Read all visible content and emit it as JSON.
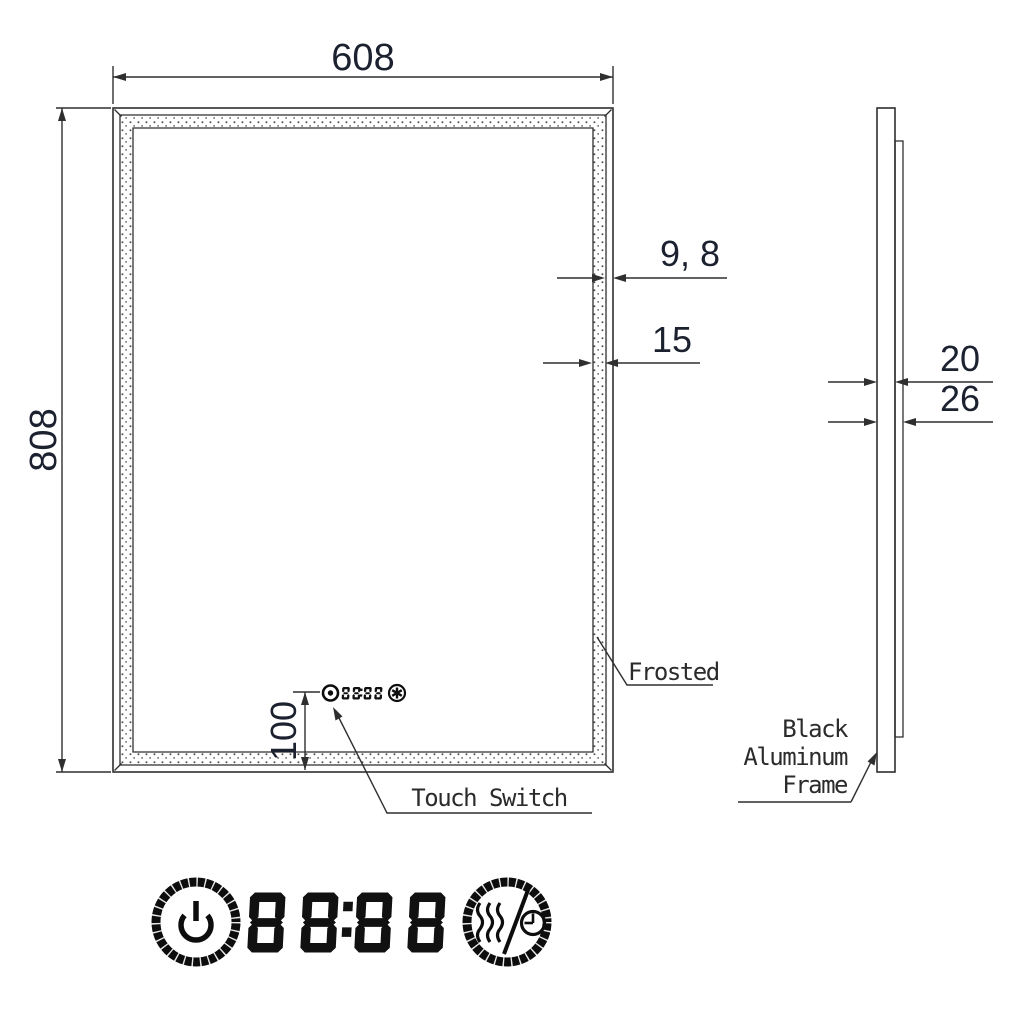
{
  "title": "LED mirror technical drawing",
  "dimensions": {
    "width": "608",
    "height": "808",
    "frame_face": "9, 8",
    "frosted_band": "15",
    "mirror_thickness": "20",
    "total_thickness": "26",
    "switch_offset": "100"
  },
  "labels": {
    "frosted": "Frosted",
    "frame_line1": "Black",
    "frame_line2": "Aluminum",
    "frame_line3": "Frame",
    "touch_switch": "Touch Switch"
  },
  "controls": {
    "display_value": "88:88",
    "mini_display_value": "88:88",
    "icons": [
      {
        "name": "power-icon"
      },
      {
        "name": "seven-segment-clock-display"
      },
      {
        "name": "defogger-timer-icon"
      }
    ],
    "mini_icons": [
      {
        "name": "power-icon"
      },
      {
        "name": "seven-segment-clock-display"
      },
      {
        "name": "fan-defog-icon"
      }
    ]
  },
  "colors": {
    "line": "#2f2f2f",
    "dim_text": "#1c2130",
    "label_text": "#2b2b2b",
    "icon": "#0d0d0d",
    "background": "#ffffff"
  }
}
